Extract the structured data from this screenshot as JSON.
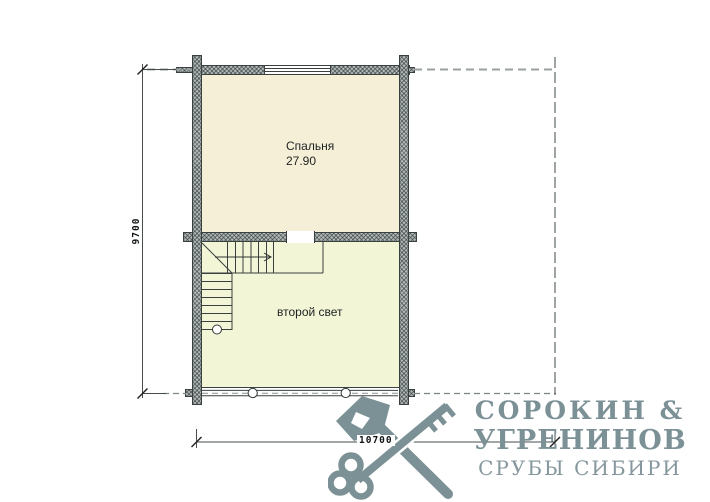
{
  "plan": {
    "type": "floor-plan",
    "rooms": [
      {
        "name": "Спальня",
        "area": "27.90"
      },
      {
        "name": "второй свет"
      }
    ],
    "dimensions": {
      "height_mm": "9700",
      "width_mm": "10700"
    },
    "features": [
      "window-top-wall",
      "opening-middle-wall",
      "l-shaped-staircase",
      "railing-with-posts"
    ]
  },
  "logo": {
    "icon": "axe-and-key-icon",
    "name_line1": "СОРОКИН &",
    "name_line2": "УГРЕНИНОВ",
    "tagline": "СРУБЫ СИБИРИ",
    "color": "#7b9196"
  },
  "colors": {
    "bedroom_fill": "#f6efd8",
    "second_light_fill": "#f2f6d6",
    "wall_fill": "#b4b9b8",
    "line": "#3a4040"
  }
}
